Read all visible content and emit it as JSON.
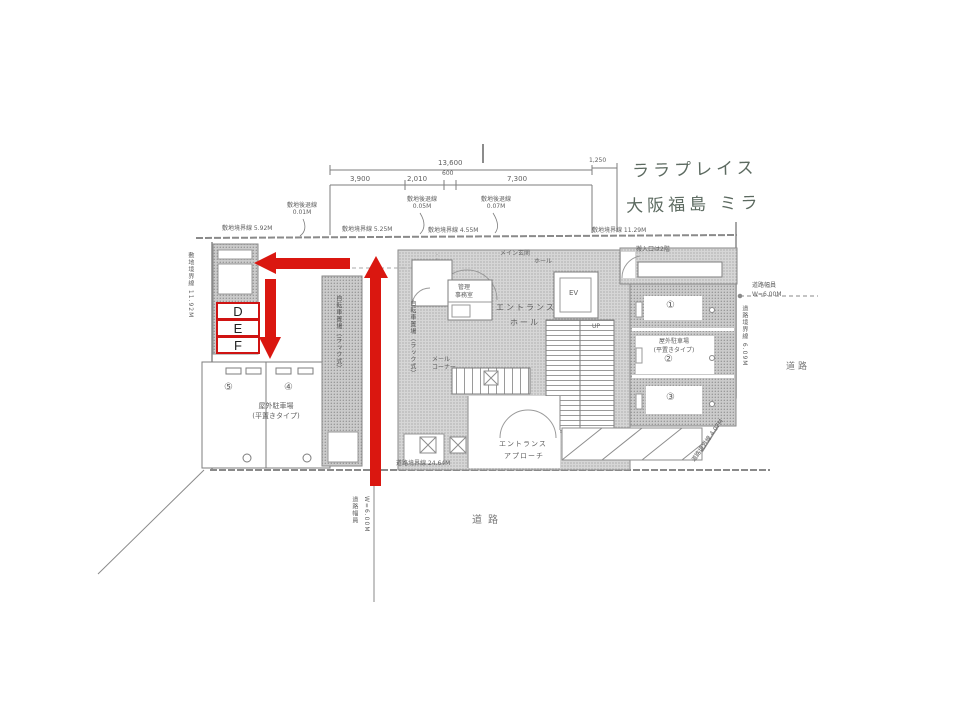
{
  "colors": {
    "annotation_red": "#da1710",
    "scan_gray": "#8a8a8a"
  },
  "handwritten_note": {
    "line1": "ララプレイス",
    "line2": "大阪福島 ミラ"
  },
  "red_annotation": {
    "box_d": "D",
    "box_e": "E",
    "box_f": "F"
  },
  "dimensions": {
    "total": "13,600",
    "seg1": "3,900",
    "seg2": "2,010",
    "seg3": "600",
    "seg4": "7,300",
    "right_offset": "1,250"
  },
  "boundaries": {
    "top1": "敷地境界線  5.92M",
    "top2": "敷地境界線  5.25M",
    "top3": "敷地境界線  4.55M",
    "top4": "敷地境界線  11.29M",
    "left_vertical": "敷地境界線 11.92M",
    "right_vertical": "道路境界線 6.09M",
    "diagonal": "道路境界線 4.07M",
    "bottom": "道路境界線  24.64M",
    "setback1_label": "敷地後退線",
    "setback1_value": "0.01M",
    "setback2_label": "敷地後退線",
    "setback2_value": "0.05M",
    "setback3_label": "敷地後退線",
    "setback3_value": "0.07M"
  },
  "roads": {
    "bottom_label": "道路",
    "right_label": "道路",
    "width_right_label": "道路幅員",
    "width_right_value": "W=6.00M",
    "width_bottom_label": "道路幅員",
    "width_bottom_value": "W=6.00M"
  },
  "rooms": {
    "main_entrance": "メイン玄関",
    "entrance_hall_line1": "エントランス",
    "entrance_hall_line2": "ホール",
    "office_line1": "管理",
    "office_line2": "事務室",
    "upper_hall": "ホール",
    "elevator": "EV",
    "stairs_up": "UP",
    "approach_line1": "エントランス",
    "approach_line2": "アプローチ",
    "bicycle": "自転車置場（ラック式）",
    "mail_line1": "メール",
    "mail_line2": "コーナー",
    "delivery_note": "搬入口は2階"
  },
  "parking": {
    "right_note_line1": "屋外駐車場",
    "right_note_line2": "(平置きタイプ)",
    "left_note_line1": "屋外駐車場",
    "left_note_line2": "(平置きタイプ)",
    "stall1": "①",
    "stall2": "②",
    "stall3": "③",
    "stall4": "④",
    "stall5": "⑤"
  }
}
